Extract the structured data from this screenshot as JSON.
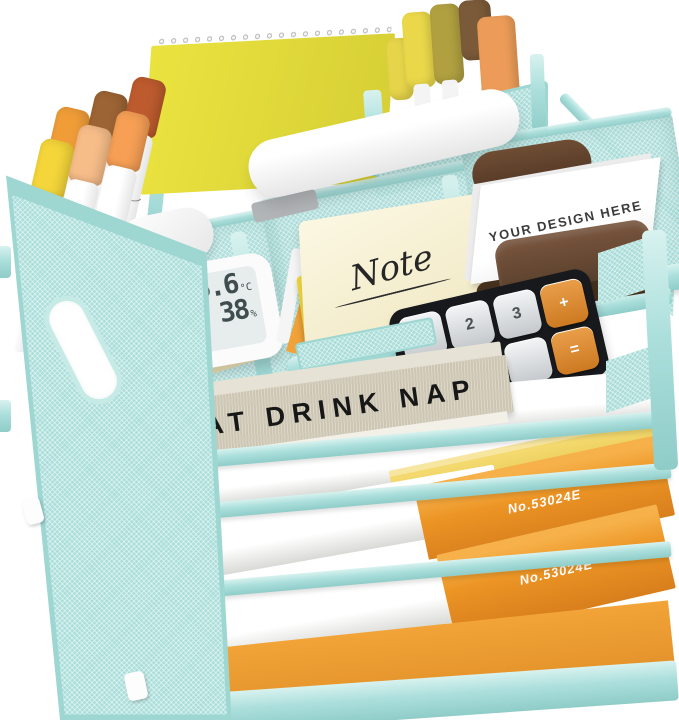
{
  "scene": {
    "type": "product-photo",
    "subject": "Mint green mesh desk organizer with five trays and stationery",
    "background_color": "#ffffff",
    "frame_color": "#a9dedb",
    "mesh_color": "#a8dcd8"
  },
  "items": {
    "notebook": {
      "name": "yellow spiral notepad",
      "color": "#e2da3d"
    },
    "round_markers": {
      "count": 6,
      "cap_colors": [
        "#f09d38",
        "#9c6434",
        "#bd5b2e",
        "#f4d53a",
        "#f7bd89",
        "#f69f55"
      ]
    },
    "flat_markers": {
      "count": 5,
      "cap_colors": [
        "#e6d44a",
        "#ead84a",
        "#b0a040",
        "#7a5a38",
        "#ec9c58"
      ]
    },
    "stapler": {
      "name": "white stapler"
    },
    "earbuds_case": {
      "name": "white earbuds case"
    },
    "thermometer": {
      "temperature": "25.6",
      "temperature_unit": "°C",
      "humidity": "38",
      "humidity_unit": "%",
      "mood_icon": "☺"
    },
    "glue_stick": {
      "brand": "UHU stic"
    },
    "photo_card": {
      "label": "4R"
    },
    "sticky_notes": {
      "label": "Note"
    },
    "pencil": {
      "name": "white pencil"
    },
    "crayon": {
      "name": "orange crayon",
      "color": "#f1a239"
    },
    "business_cards": {
      "label": "YOUR DESIGN HERE"
    },
    "card_holder": {
      "name": "brown card holder",
      "color": "#5d4231"
    },
    "calculator": {
      "key_1": "1",
      "key_2": "2",
      "key_3": "3",
      "key_plus": "+",
      "key_0": "0",
      "key_dot": ".",
      "key_eq": "="
    },
    "book": {
      "title": "EAT DRINK NAP"
    },
    "paper": {
      "name": "white letter paper"
    },
    "yellow_folder": {
      "color": "#e9c94e"
    },
    "orange_folder_top": {
      "label": "No.53024E",
      "color": "#ec9424"
    },
    "orange_folder_bottom": {
      "label": "No.53024E",
      "color": "#ec9424"
    }
  }
}
